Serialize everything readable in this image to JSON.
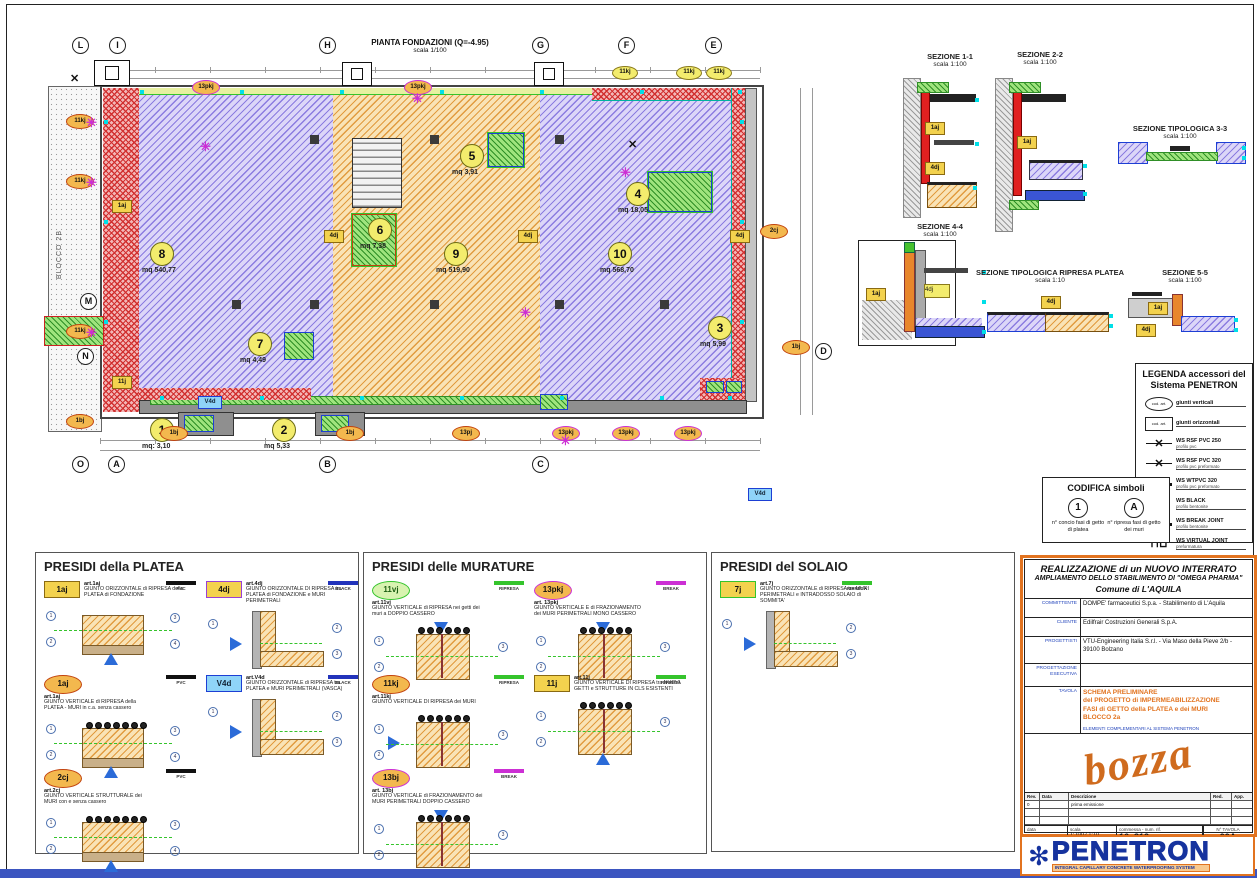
{
  "plan": {
    "title": "PIANTA FONDAZIONI (Q=-4.95)",
    "scale": "scala 1/100",
    "block_label": "BLOCCO 2B",
    "grid_markers": [
      {
        "label": "L",
        "x": 72,
        "y": 37
      },
      {
        "label": "I",
        "x": 109,
        "y": 37
      },
      {
        "label": "H",
        "x": 319,
        "y": 37
      },
      {
        "label": "G",
        "x": 532,
        "y": 37
      },
      {
        "label": "F",
        "x": 618,
        "y": 37
      },
      {
        "label": "E",
        "x": 705,
        "y": 37
      },
      {
        "label": "O",
        "x": 72,
        "y": 456
      },
      {
        "label": "A",
        "x": 108,
        "y": 456
      },
      {
        "label": "B",
        "x": 319,
        "y": 456
      },
      {
        "label": "C",
        "x": 532,
        "y": 456
      },
      {
        "label": "M",
        "x": 80,
        "y": 293
      },
      {
        "label": "N",
        "x": 77,
        "y": 348
      },
      {
        "label": "D",
        "x": 815,
        "y": 343
      }
    ],
    "zones": [
      {
        "num": "1",
        "area": "mq: 3,10",
        "x": 150,
        "y": 418
      },
      {
        "num": "2",
        "area": "mq 5,33",
        "x": 272,
        "y": 418
      },
      {
        "num": "3",
        "area": "mq 5,99",
        "x": 708,
        "y": 316
      },
      {
        "num": "4",
        "area": "mq 18,05",
        "x": 626,
        "y": 182
      },
      {
        "num": "5",
        "area": "mq 3,91",
        "x": 460,
        "y": 144
      },
      {
        "num": "6",
        "area": "mq 7,38",
        "x": 368,
        "y": 218
      },
      {
        "num": "7",
        "area": "mq 4,49",
        "x": 248,
        "y": 332
      },
      {
        "num": "8",
        "area": "mq 540,77",
        "x": 150,
        "y": 242
      },
      {
        "num": "9",
        "area": "mq 519,90",
        "x": 444,
        "y": 242
      },
      {
        "num": "10",
        "area": "mq 568,70",
        "x": 608,
        "y": 242
      }
    ],
    "symbols": [
      {
        "shape": "oval-magenta",
        "label": "13pkj",
        "x": 192,
        "y": 80
      },
      {
        "shape": "oval-magenta",
        "label": "13pkj",
        "x": 404,
        "y": 80
      },
      {
        "shape": "oval-yellow",
        "label": "11kj",
        "x": 612,
        "y": 66
      },
      {
        "shape": "oval-yellow",
        "label": "11kj",
        "x": 676,
        "y": 66
      },
      {
        "shape": "oval-yellow",
        "label": "11kj",
        "x": 706,
        "y": 66
      },
      {
        "shape": "oval-orange",
        "label": "11kj",
        "x": 66,
        "y": 114
      },
      {
        "shape": "oval-orange",
        "label": "11kj",
        "x": 66,
        "y": 174
      },
      {
        "shape": "oval-orange",
        "label": "11kj",
        "x": 66,
        "y": 324
      },
      {
        "shape": "oval-orange",
        "label": "1bj",
        "x": 66,
        "y": 414
      },
      {
        "shape": "oval-orange",
        "label": "1bj",
        "x": 160,
        "y": 426
      },
      {
        "shape": "oval-orange",
        "label": "1bj",
        "x": 336,
        "y": 426
      },
      {
        "shape": "oval-orange",
        "label": "13pj",
        "x": 452,
        "y": 426
      },
      {
        "shape": "oval-magenta",
        "label": "13pkj",
        "x": 552,
        "y": 426
      },
      {
        "shape": "oval-magenta",
        "label": "13pkj",
        "x": 612,
        "y": 426
      },
      {
        "shape": "oval-magenta",
        "label": "13pkj",
        "x": 674,
        "y": 426
      },
      {
        "shape": "oval-orange",
        "label": "2cj",
        "x": 760,
        "y": 224
      },
      {
        "shape": "oval-orange",
        "label": "1bj",
        "x": 782,
        "y": 340
      },
      {
        "shape": "rect-yellow",
        "label": "4dj",
        "x": 324,
        "y": 230
      },
      {
        "shape": "rect-yellow",
        "label": "4dj",
        "x": 518,
        "y": 230
      },
      {
        "shape": "rect-yellow",
        "label": "4dj",
        "x": 730,
        "y": 230
      },
      {
        "shape": "rect-yellow",
        "label": "1aj",
        "x": 112,
        "y": 200
      },
      {
        "shape": "rect-yellow",
        "label": "11j",
        "x": 112,
        "y": 376
      },
      {
        "shape": "rect-blue",
        "label": "V4d",
        "x": 198,
        "y": 396
      },
      {
        "shape": "rect-blue",
        "label": "V4d",
        "x": 748,
        "y": 488
      },
      {
        "shape": "star-m",
        "label": "",
        "x": 86,
        "y": 116
      },
      {
        "shape": "star-m",
        "label": "",
        "x": 86,
        "y": 176
      },
      {
        "shape": "star-m",
        "label": "",
        "x": 86,
        "y": 326
      },
      {
        "shape": "star-m",
        "label": "",
        "x": 200,
        "y": 140
      },
      {
        "shape": "star-m",
        "label": "",
        "x": 412,
        "y": 92
      },
      {
        "shape": "star-m",
        "label": "",
        "x": 520,
        "y": 306
      },
      {
        "shape": "star-m",
        "label": "",
        "x": 620,
        "y": 166
      },
      {
        "shape": "star-m",
        "label": "",
        "x": 560,
        "y": 434
      },
      {
        "shape": "star-k",
        "label": "",
        "x": 70,
        "y": 74
      },
      {
        "shape": "star-k",
        "label": "",
        "x": 628,
        "y": 140
      }
    ]
  },
  "sections": [
    {
      "id": "s11",
      "title": "SEZIONE 1-1",
      "scale": "scala 1:100"
    },
    {
      "id": "s22",
      "title": "SEZIONE 2-2",
      "scale": "scala 1:100"
    },
    {
      "id": "s33",
      "title": "SEZIONE TIPOLOGICA 3-3",
      "scale": "scala 1:100"
    },
    {
      "id": "s44",
      "title": "SEZIONE 4-4",
      "scale": "scala 1:100"
    },
    {
      "id": "srp",
      "title": "SEZIONE TIPOLOGICA RIPRESA PLATEA",
      "scale": "scala 1:10"
    },
    {
      "id": "s55",
      "title": "SEZIONE 5-5",
      "scale": "scala 1:100"
    }
  ],
  "legend": {
    "title_line1": "LEGENDA accessori del",
    "title_line2": "Sistema PENETRON",
    "items": [
      {
        "sym": "oval",
        "code": "cod. art.",
        "name": "giunti verticali",
        "sub": ""
      },
      {
        "sym": "rect",
        "code": "cod. art.",
        "name": "giunti orizzontali",
        "sub": ""
      },
      {
        "sym": "xbar",
        "code": "",
        "name": "WS RSF PVC 250",
        "sub": "profilo pvc"
      },
      {
        "sym": "xbar",
        "code": "",
        "name": "WS RSF PVC 320",
        "sub": "profilo pvc preformato"
      },
      {
        "sym": "xbold",
        "code": "",
        "name": "WS WTPVC 320",
        "sub": "profilo pvc preformato"
      },
      {
        "sym": "xthin",
        "code": "",
        "name": "WS BLACK",
        "sub": "profilo bentonite"
      },
      {
        "sym": "xbold",
        "code": "",
        "name": "WS BREAK JOINT",
        "sub": "profilo bentonite"
      },
      {
        "sym": "step",
        "code": "",
        "name": "WS VIRTUAL JOINT",
        "sub": "preformatura"
      },
      {
        "sym": "xdot",
        "code": "",
        "name": "WATER JOINT B.2.5.25",
        "sub": "preformatura idroespansiva"
      }
    ]
  },
  "codifica": {
    "title": "CODIFICA simboli",
    "items": [
      {
        "symbol": "1",
        "caption": "n° concio fasi di getto di platea"
      },
      {
        "symbol": "A",
        "caption": "n° ripresa fasi di getto dei muri"
      }
    ]
  },
  "presidi": [
    {
      "title": "PRESIDI della PLATEA",
      "items": [
        {
          "badge": "1aj",
          "style": "rect-yellow",
          "art": "art.1aj",
          "desc": "GIUNTO ORIZZONTALE di RIPRESA della PLATEA di FONDAZIONE",
          "tag": "PVC",
          "schem": "slab"
        },
        {
          "badge": "4dj",
          "style": "rect-yellow-purple",
          "art": "art.4dj",
          "desc": "GIUNTO ORIZZONTALE DI RIPRESA tra PLATEA di FONDAZIONE e MURI PERIMETRALI",
          "tag": "BLACK",
          "schem": "corner"
        },
        {
          "badge": "1aj",
          "style": "oval-orange",
          "art": "art.1aj",
          "desc": "GIUNTO VERTICALE di RIPRESA della PLATEA - MURI in c.a. senza cassero",
          "tag": "PVC",
          "schem": "slabrebar"
        },
        {
          "badge": "V4d",
          "style": "rect-blue",
          "art": "art.V4d",
          "desc": "GIUNTO ORIZZONTALE di RIPRESA tra PLATEA e MURI PERIMETRALI (VASCA)",
          "tag": "BLACK",
          "schem": "corner"
        },
        {
          "badge": "2cj",
          "style": "oval-orange",
          "art": "art.2cj",
          "desc": "GIUNTO VERTICALE STRUTTURALE dei MURI con e senza cassero",
          "tag": "PVC",
          "schem": "slabrebar"
        }
      ]
    },
    {
      "title": "PRESIDI delle MURATURE",
      "items": [
        {
          "badge": "11vj",
          "style": "oval-green",
          "art": "art.11vj",
          "desc": "GIUNTO VERTICALE di RIPRESA nei getti dei muri a DOPPIO CASSERO",
          "tag": "RIPRESA",
          "schem": "wall"
        },
        {
          "badge": "13pkj",
          "style": "oval-magenta",
          "art": "art. 13pkj",
          "desc": "GIUNTO VERTICALE E di FRAZIONAMENTO dei MURI PERIMETRALI MONO CASSERO",
          "tag": "BREAK",
          "schem": "wall"
        },
        {
          "badge": "11kj",
          "style": "oval-orange",
          "art": "art.11kj",
          "desc": "GIUNTO VERTICALE DI RIPRESA dei MURI",
          "tag": "RIPRESA",
          "schem": "wallside"
        },
        {
          "badge": "11j",
          "style": "rect-yellow",
          "art": "art.11j",
          "desc": "GIUNTO VERTICALE DI RIPRESA tra NUOVI GETTI e STRUTTURE IN CLS ESISTENTI",
          "tag": "RIPRESA",
          "schem": "wallup"
        },
        {
          "badge": "13bj",
          "style": "oval-magenta",
          "art": "art. 13bj",
          "desc": "GIUNTO VERTICALE di FRAZIONAMENTO dei MURI PERIMETRALI DOPPIO CASSERO",
          "tag": "BREAK",
          "schem": "wall"
        }
      ]
    },
    {
      "title": "PRESIDI del SOLAIO",
      "items": [
        {
          "badge": "7j",
          "style": "rect-yellow-green",
          "art": "art.7j",
          "desc": "GIUNTO ORIZZONTALE di RIPRESA tra MURI PERIMETRALI e INTRADOSSO SOLAIO di SOMMITA'",
          "tag": "RIPRESA",
          "schem": "corner"
        }
      ]
    }
  ],
  "titleblock": {
    "title1": "REALIZZAZIONE di un NUOVO INTERRATO",
    "title2": "AMPLIAMENTO DELLO STABILIMENTO DI \"OMEGA PHARMA\"",
    "title3": "Comune di L'AQUILA",
    "rows": [
      {
        "label": "COMMITTENTE",
        "value": "DOMPE' farmaceutici S.p.a. - Stabilimento di L'Aquila"
      },
      {
        "label": "CLIENTE",
        "value": "Edilfrair Costruzioni Generali S.p.A."
      },
      {
        "label": "PROGETTISTI",
        "value": "VTU-Engineering Italia S.r.l. - Via Maso della Pieve 2/b - 39100 Bolzano"
      },
      {
        "label": "PROGETTAZIONE ESECUTIVA",
        "value": ""
      }
    ],
    "tavola_label": "TAVOLA",
    "tavola_lines": [
      "SCHEMA PRELIMINARE",
      "del PROGETTO di IMPERMEABILIZZAZIONE",
      "FASI di GETTO della PLATEA e dei MURI",
      "BLOCCO 2a"
    ],
    "tavola_note": "ELEMENTI COMPLEMENTARI AL SISTEMA PENETRON",
    "watermark": "bozza",
    "rev_headers": [
      "Rev.",
      "Data",
      "Descrizione",
      "Red.",
      "App."
    ],
    "rev_first_row": [
      "0",
      "",
      "prima emissione",
      "",
      ""
    ],
    "fields": {
      "data_label": "data",
      "scala_label": "scala",
      "scala_value": "1:100 / 1:10",
      "commessa_label": "commessa - num. rif.",
      "commessa_value": "16_312",
      "tavola_num_label": "N° TAVOLA",
      "tavola_num": "00A"
    }
  },
  "logo": {
    "name": "PENETRON",
    "tagline": "INTEGRAL CAPILLARY CONCRETE WATERPROOFING SYSTEM"
  },
  "colors": {
    "accent_orange": "#e2731f",
    "penetron_blue": "#16339e",
    "ripresa_green": "#35c42c",
    "break_magenta": "#cc2fd4",
    "black_joint": "#2233bb",
    "pvc_black": "#111111"
  }
}
